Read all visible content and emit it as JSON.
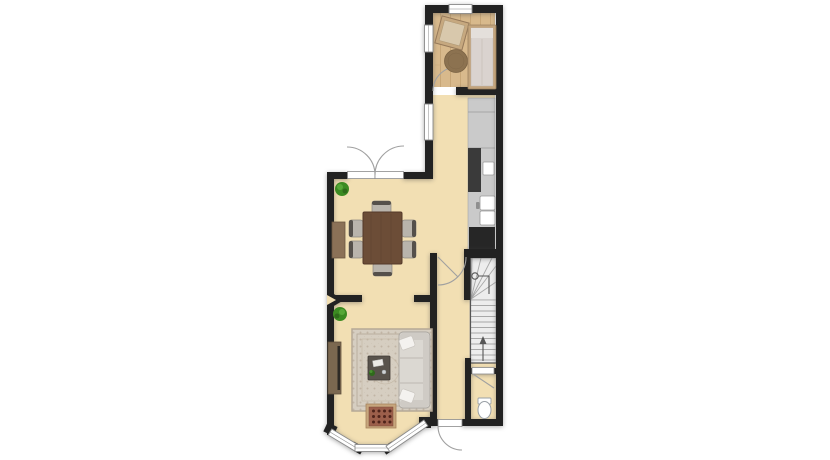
{
  "colors": {
    "wall": "#222222",
    "floorCream": "#F2DFB3",
    "wood": "#D8B98C",
    "woodLine": "#C7A677",
    "counter": "#CACACA",
    "applianceDark": "#3A3A3A",
    "applianceDarker": "#262626",
    "stair": "#EDEDED",
    "stairLine": "#A8A8A8",
    "rugBase": "#D6CEC1",
    "rugLine": "#B5A896",
    "sofa": "#DBD8D2",
    "sofaShade": "#CFCBC5",
    "pillow": "#F4F2EF",
    "tableWood": "#6C4D37",
    "chair": "#B9B4AC",
    "chairBack": "#55504B",
    "sideboard": "#8B7157",
    "console": "#7B6850",
    "fireBorder": "#C7A67D",
    "fireBrick": "#9C5F4B",
    "fireDot": "#4F241B",
    "plant": "#3C8B22",
    "plantDark": "#2F6B1B",
    "plantLight": "#57A838",
    "roundRug": "#8C7250",
    "bedFrame": "#C3A47C",
    "bedInner": "#DAD3CF",
    "windowFrame": "#8B8B8B",
    "doorArc": "#A0A0A0",
    "background": "#FFFFFF"
  },
  "floorplan": {
    "rooms": [
      {
        "name": "bedroom",
        "floor": "wood"
      },
      {
        "name": "kitchen",
        "floor": "cream"
      },
      {
        "name": "dining-room",
        "floor": "cream"
      },
      {
        "name": "living-room",
        "floor": "cream"
      },
      {
        "name": "hallway",
        "floor": "cream"
      },
      {
        "name": "wc",
        "floor": "cream"
      },
      {
        "name": "staircase",
        "floor": "stairs"
      }
    ],
    "furniture": [
      "double-bed",
      "tilted-side-table",
      "round-rug",
      "kitchen-counter",
      "tall-dark-appliance",
      "small-appliance",
      "sink-unit",
      "fridge-unit",
      "dining-table",
      "dining-chair",
      "dining-chair",
      "dining-chair",
      "dining-chair",
      "dining-chair",
      "dining-chair",
      "sideboard",
      "potted-plant",
      "potted-plant",
      "area-rug",
      "sofa",
      "sofa-pillow",
      "sofa-pillow",
      "coffee-table",
      "fireplace-hearth",
      "tv-console",
      "toilet"
    ],
    "features": [
      "french-doors",
      "front-door",
      "bay-window",
      "interior-door",
      "wc-door",
      "window-top",
      "window-bedroom-left",
      "window-kitchen-left",
      "stairs-winders",
      "stairs-straight-run",
      "stairs-up-arrow",
      "stairs-start-circle",
      "wall-junction-marker"
    ]
  }
}
